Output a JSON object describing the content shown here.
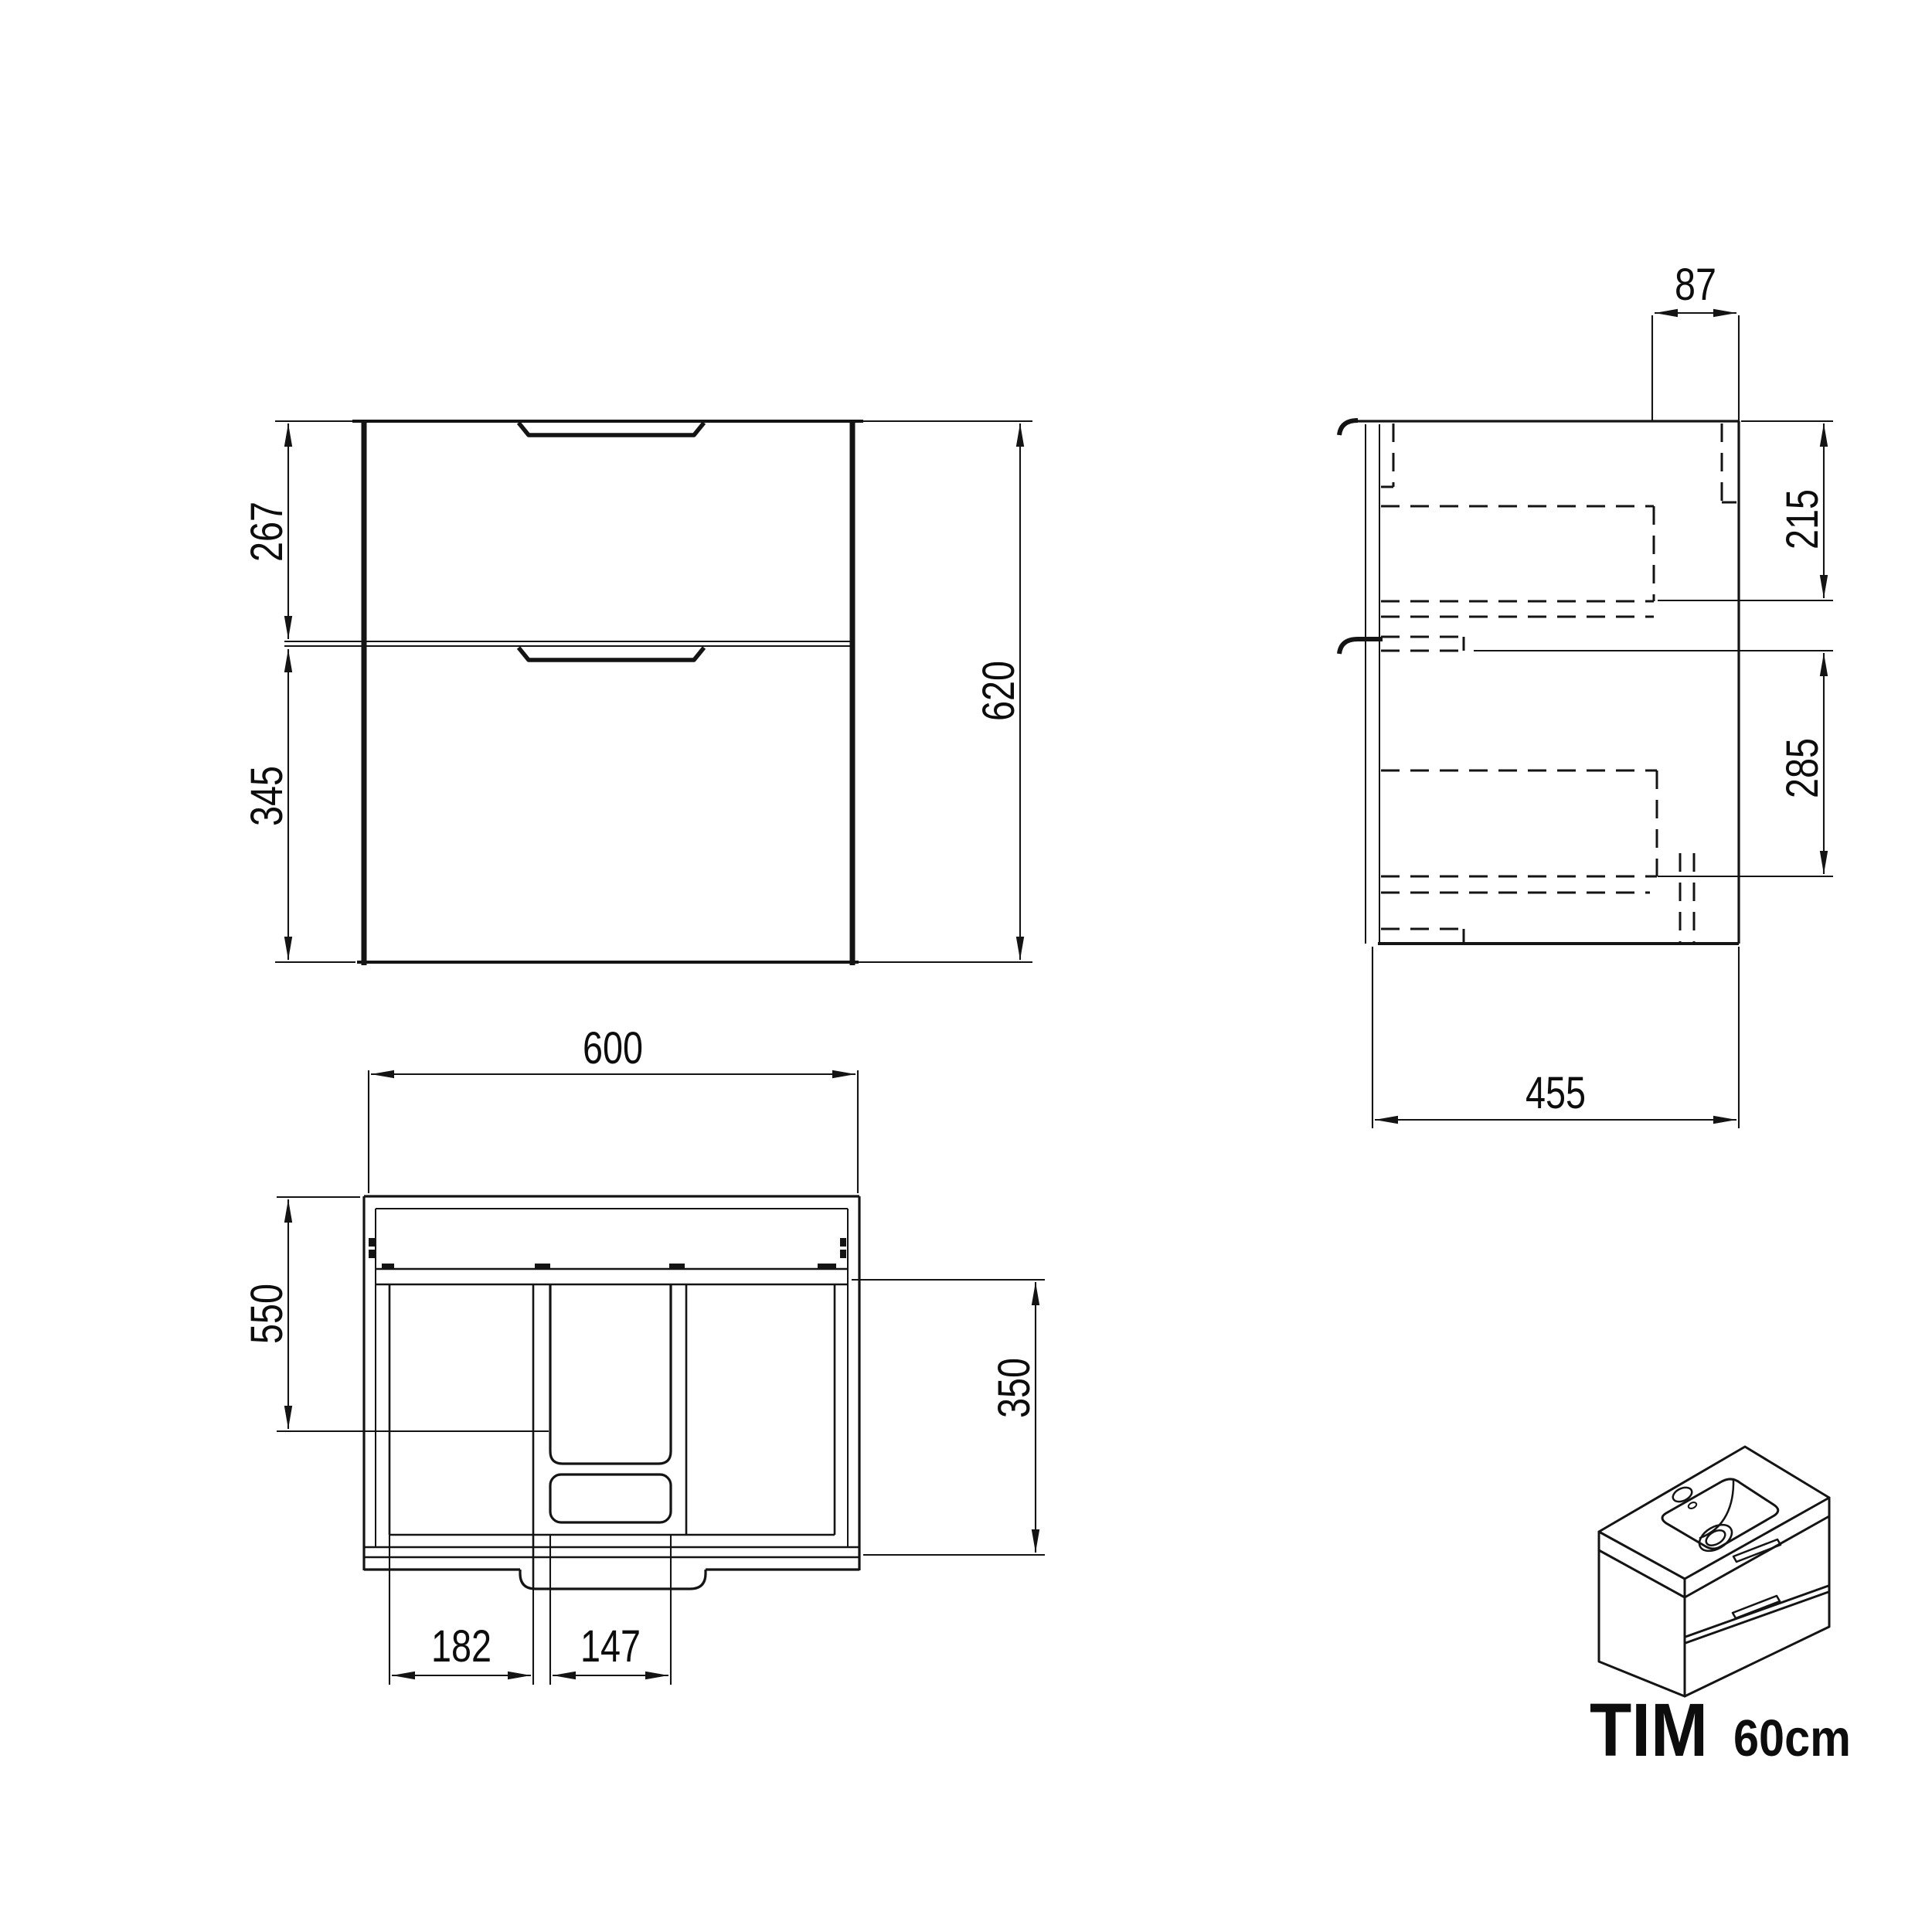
{
  "title": {
    "model": "TIM",
    "size": "60cm"
  },
  "dims": {
    "front": {
      "upper": "267",
      "lower": "345",
      "total": "620"
    },
    "side": {
      "top": "87",
      "upper": "215",
      "lower": "285",
      "depth": "455"
    },
    "plan": {
      "width": "600",
      "depth": "550",
      "drawer": "350",
      "left": "182",
      "center": "147"
    }
  }
}
